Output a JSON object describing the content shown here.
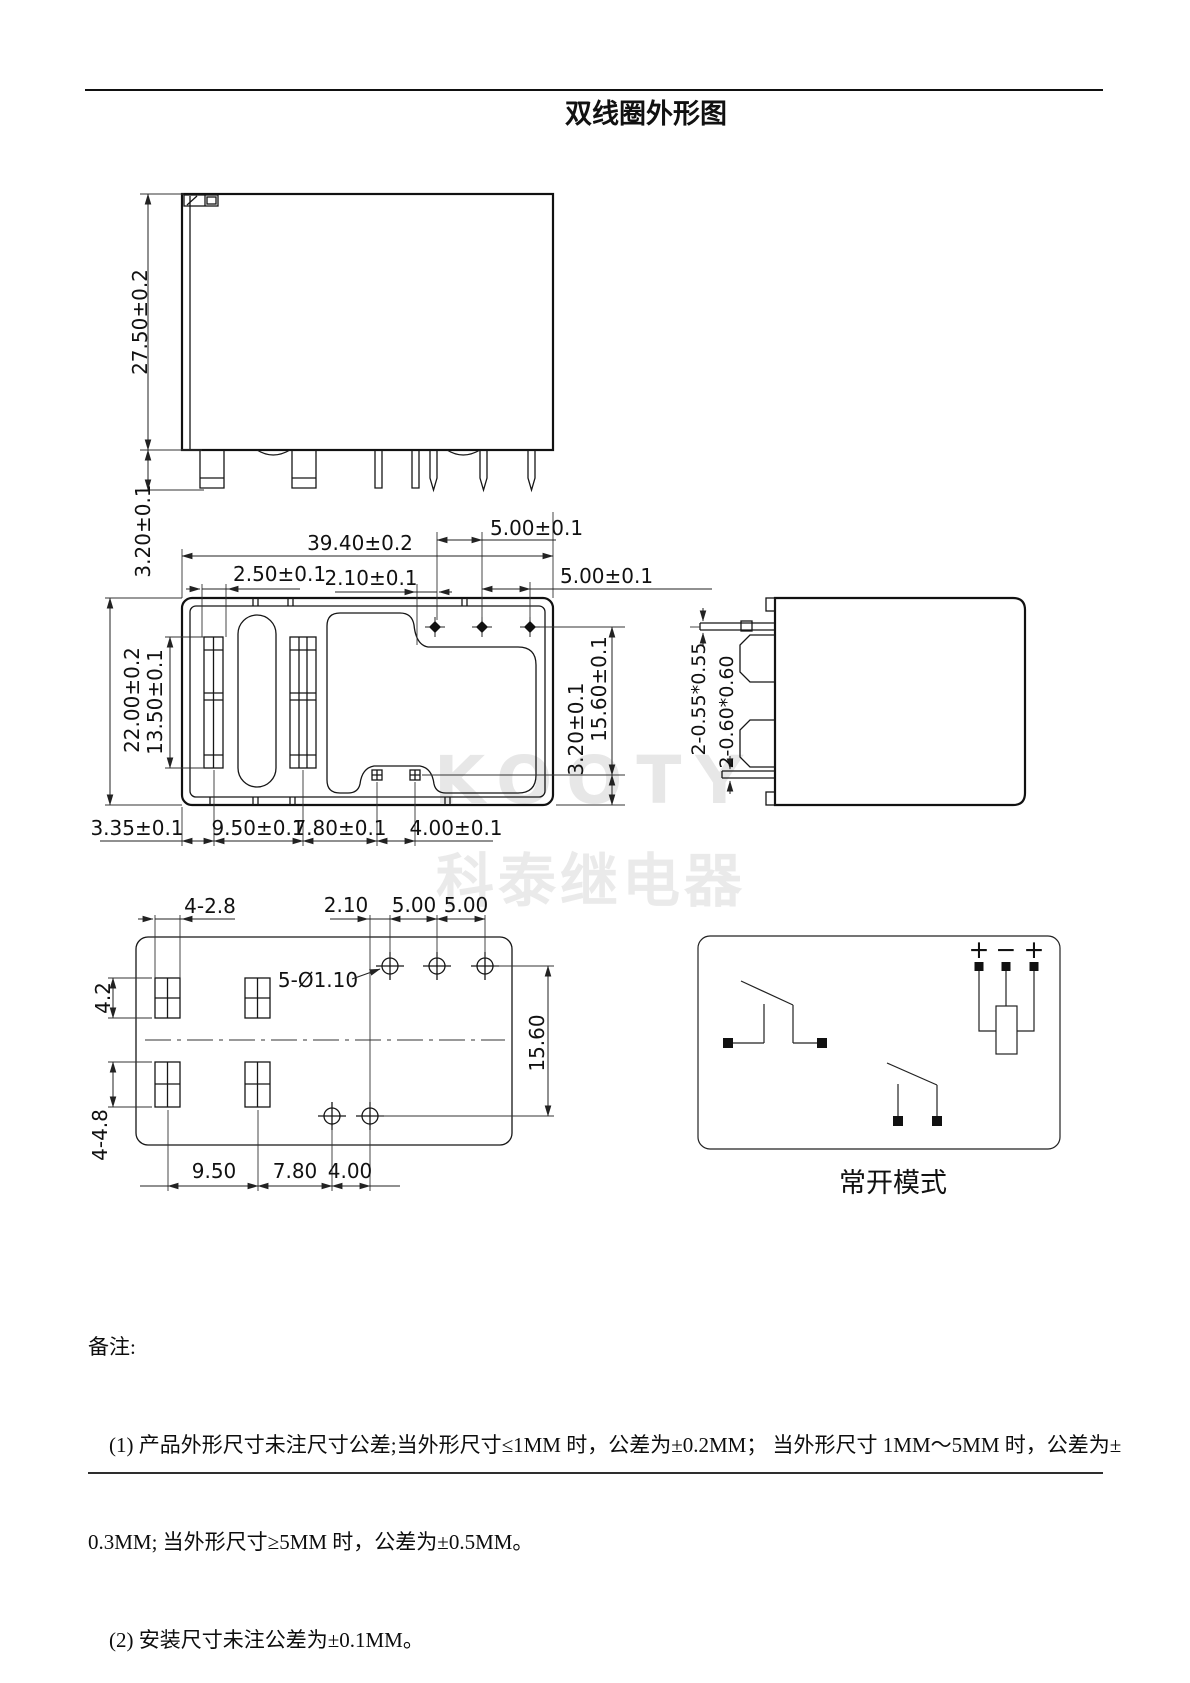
{
  "title": "双线圈外形图",
  "watermark": {
    "latin": "KOOTY",
    "cjk": "科泰继电器",
    "color": "#e7e7e7"
  },
  "front_view": {
    "height": "27.50±0.2",
    "stand_off": "3.20±0.1"
  },
  "bottom_view": {
    "width": "39.40±0.2",
    "pitch_a": "5.00±0.1",
    "pitch_b": "5.00±0.1",
    "slot": "2.50±0.1",
    "offset": "2.10±0.1",
    "depth": "22.00±0.2",
    "slot_span": "13.50±0.1",
    "row_span": "15.60±0.1",
    "edge": "3.20±0.1",
    "d335": "3.35±0.1",
    "d950": "9.50±0.1",
    "d780": "7.80±0.1",
    "d400": "4.00±0.1"
  },
  "side_view": {
    "pin_small": "2-0.55*0.55",
    "pin_large": "2-0.60*0.60"
  },
  "pcb_view": {
    "pads_top": "4-2.8",
    "d210": "2.10",
    "d500a": "5.00",
    "d500b": "5.00",
    "holes": "5-Ø1.10",
    "d42": "4.2",
    "d1560": "15.60",
    "pads_bottom": "4-4.8",
    "d950": "9.50",
    "d780": "7.80",
    "d400": "4.00"
  },
  "circuit": {
    "plus_left": "+",
    "minus": "−",
    "plus_right": "+",
    "caption": "常开模式"
  },
  "notes": {
    "label": "备注:",
    "line1": "    (1) 产品外形尺寸未注尺寸公差;当外形尺寸≤1MM 时，公差为±0.2MM； 当外形尺寸 1MM～5MM 时，公差为±",
    "line2": "0.3MM; 当外形尺寸≥5MM 时，公差为±0.5MM。",
    "line3": "    (2) 安装尺寸未注公差为±0.1MM。"
  }
}
